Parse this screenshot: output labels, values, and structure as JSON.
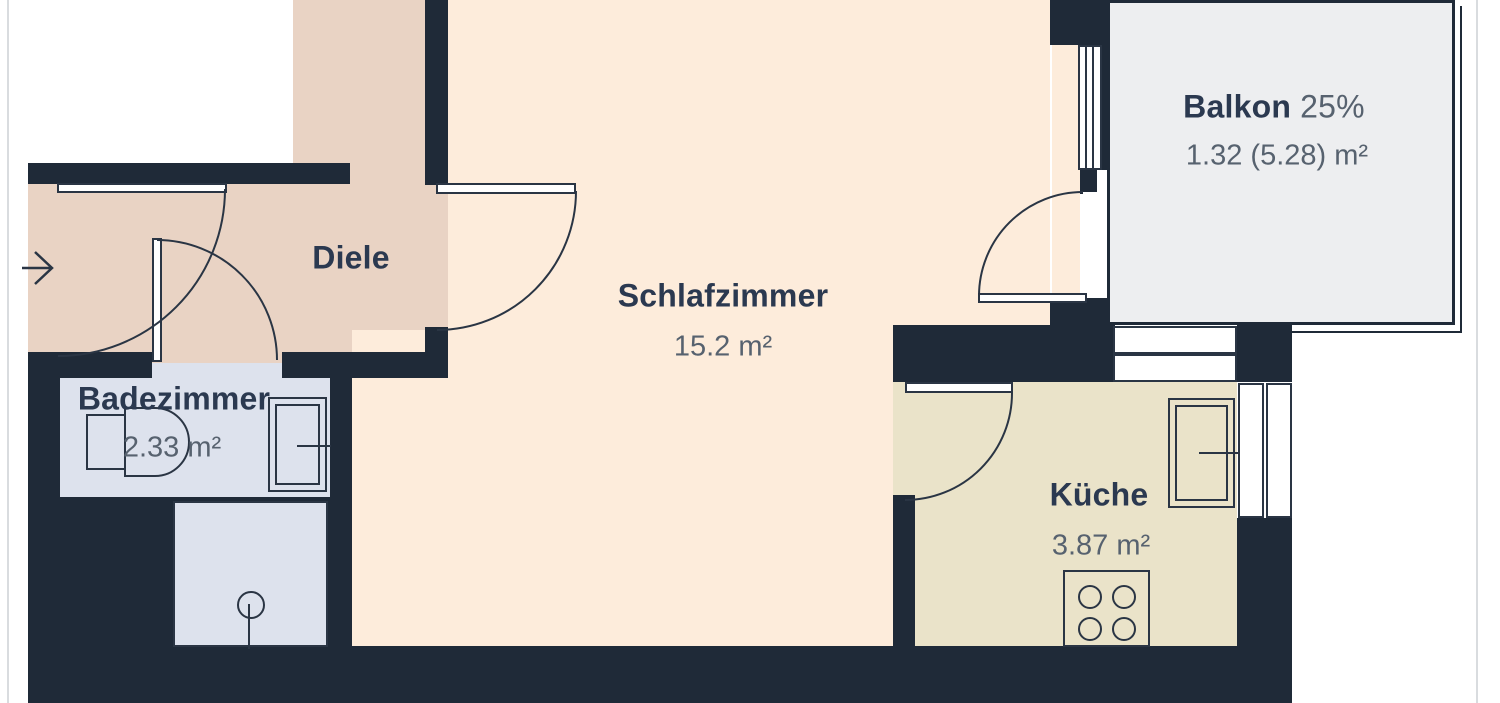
{
  "floorplan": {
    "rooms": [
      {
        "name": "Diele",
        "color": "#e9d3c4"
      },
      {
        "name": "Schlafzimmer",
        "area": "15.2 m²",
        "color": "#fdecdb"
      },
      {
        "name": "Badezimmer",
        "area": "2.33 m²",
        "color": "#dde2ed"
      },
      {
        "name": "Küche",
        "area": "3.87 m²",
        "color": "#eae3c9"
      },
      {
        "name": "Balkon",
        "share": "25%",
        "area": "1.32 (5.28) m²",
        "color": "#edeef0"
      }
    ],
    "colors": {
      "wall": "#1f2a38",
      "line": "#2a3544",
      "title_text": "#2b3950",
      "area_text": "#57626f",
      "outside": "#ffffff"
    },
    "icons": [
      "entry-arrow-icon",
      "door-swing-arc",
      "window",
      "toilet-icon",
      "sink-icon",
      "shower-icon",
      "stove-icon"
    ]
  }
}
